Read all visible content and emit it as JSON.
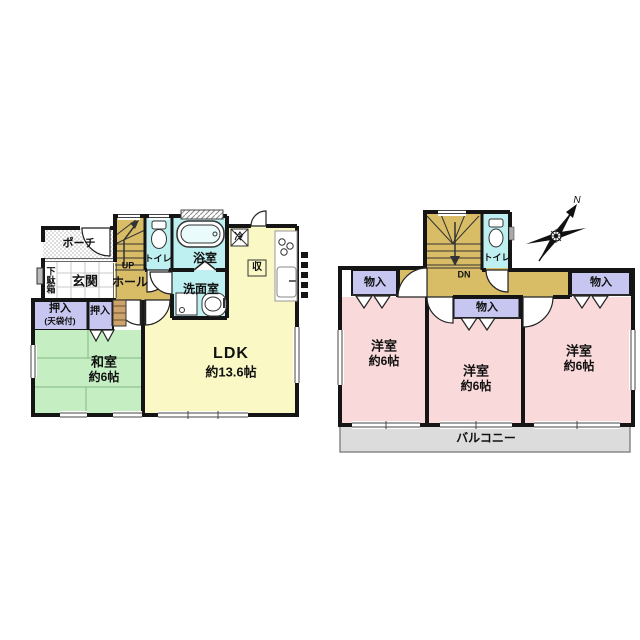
{
  "title": "2-story house floor plan",
  "colors": {
    "wall": "#151515",
    "stairs_hall": "#D8BC66",
    "water_rooms": "#BEEFF1",
    "ldk": "#FAF9C5",
    "tatami_room": "#C5EFC2",
    "closet": "#C6C6F0",
    "western_room": "#F9D9DA",
    "balcony": "#DCDCDC"
  },
  "compass": {
    "north": "N"
  },
  "floor1": {
    "porch": "ポーチ",
    "entrance": "玄関",
    "shoe_cabinet": "下駄箱",
    "hall": "ホール",
    "stairs_up": "UP",
    "toilet": "トイレ",
    "bath": "浴室",
    "washroom": "洗面室",
    "refrigerator": "冷",
    "storage": "収",
    "closet_main": "押入",
    "closet_main_note": "(天袋付)",
    "closet_small": "押入",
    "japanese_room": "和室",
    "japanese_room_size": "約6帖",
    "ldk": "LDK",
    "ldk_size": "約13.6帖"
  },
  "floor2": {
    "stairs_down": "DN",
    "toilet": "トイレ",
    "storage_left": "物入",
    "storage_center": "物入",
    "storage_right": "物入",
    "western_room_left": "洋室",
    "western_room_left_size": "約6帖",
    "western_room_center": "洋室",
    "western_room_center_size": "約6帖",
    "western_room_right": "洋室",
    "western_room_right_size": "約6帖",
    "balcony": "バルコニー"
  }
}
